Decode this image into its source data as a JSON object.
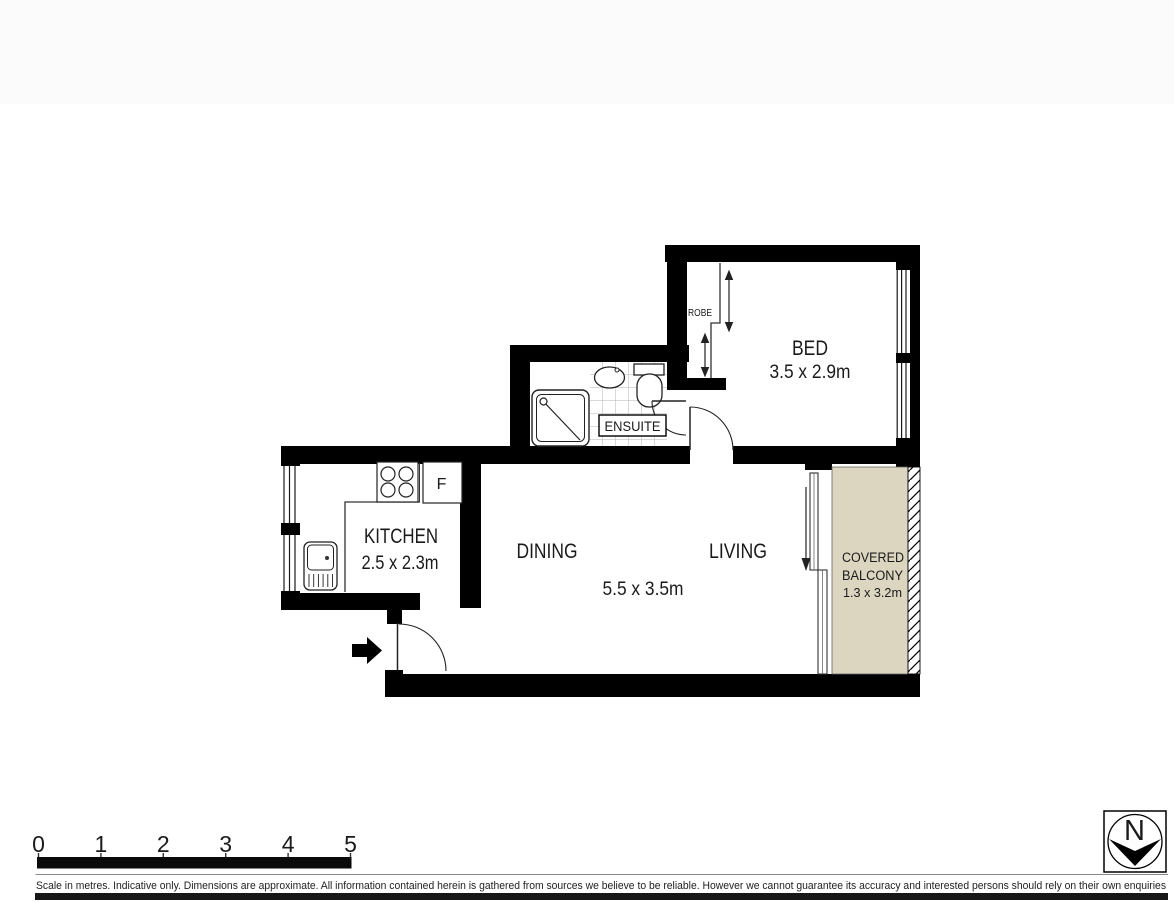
{
  "plan": {
    "rooms": {
      "bed": {
        "label": "BED",
        "dims": "3.5 x 2.9m"
      },
      "robe": {
        "label": "ROBE"
      },
      "ensuite": {
        "label": "ENSUITE"
      },
      "kitchen": {
        "label": "KITCHEN",
        "dims": "2.5 x 2.3m"
      },
      "dining": {
        "label": "DINING"
      },
      "living": {
        "label": "LIVING"
      },
      "living_dining_dims": "5.5 x 3.5m",
      "balcony": {
        "label_line1": "COVERED",
        "label_line2": "BALCONY",
        "dims": "1.3 x 3.2m"
      }
    },
    "appliances": {
      "fridge_label": "F"
    }
  },
  "scale_bar": {
    "tick_labels": [
      "0",
      "1",
      "2",
      "3",
      "4",
      "5"
    ]
  },
  "compass": {
    "north_label": "N"
  },
  "footer": {
    "disclaimer": "Scale in metres. Indicative only. Dimensions are approximate. All information contained herein is gathered from sources we believe to be reliable. However we cannot guarantee its accuracy and interested persons should rely on their own enquiries"
  },
  "colors": {
    "wall": "#000000",
    "balcony_fill": "#dcd6c0",
    "tile_line": "#b3b3b3"
  }
}
